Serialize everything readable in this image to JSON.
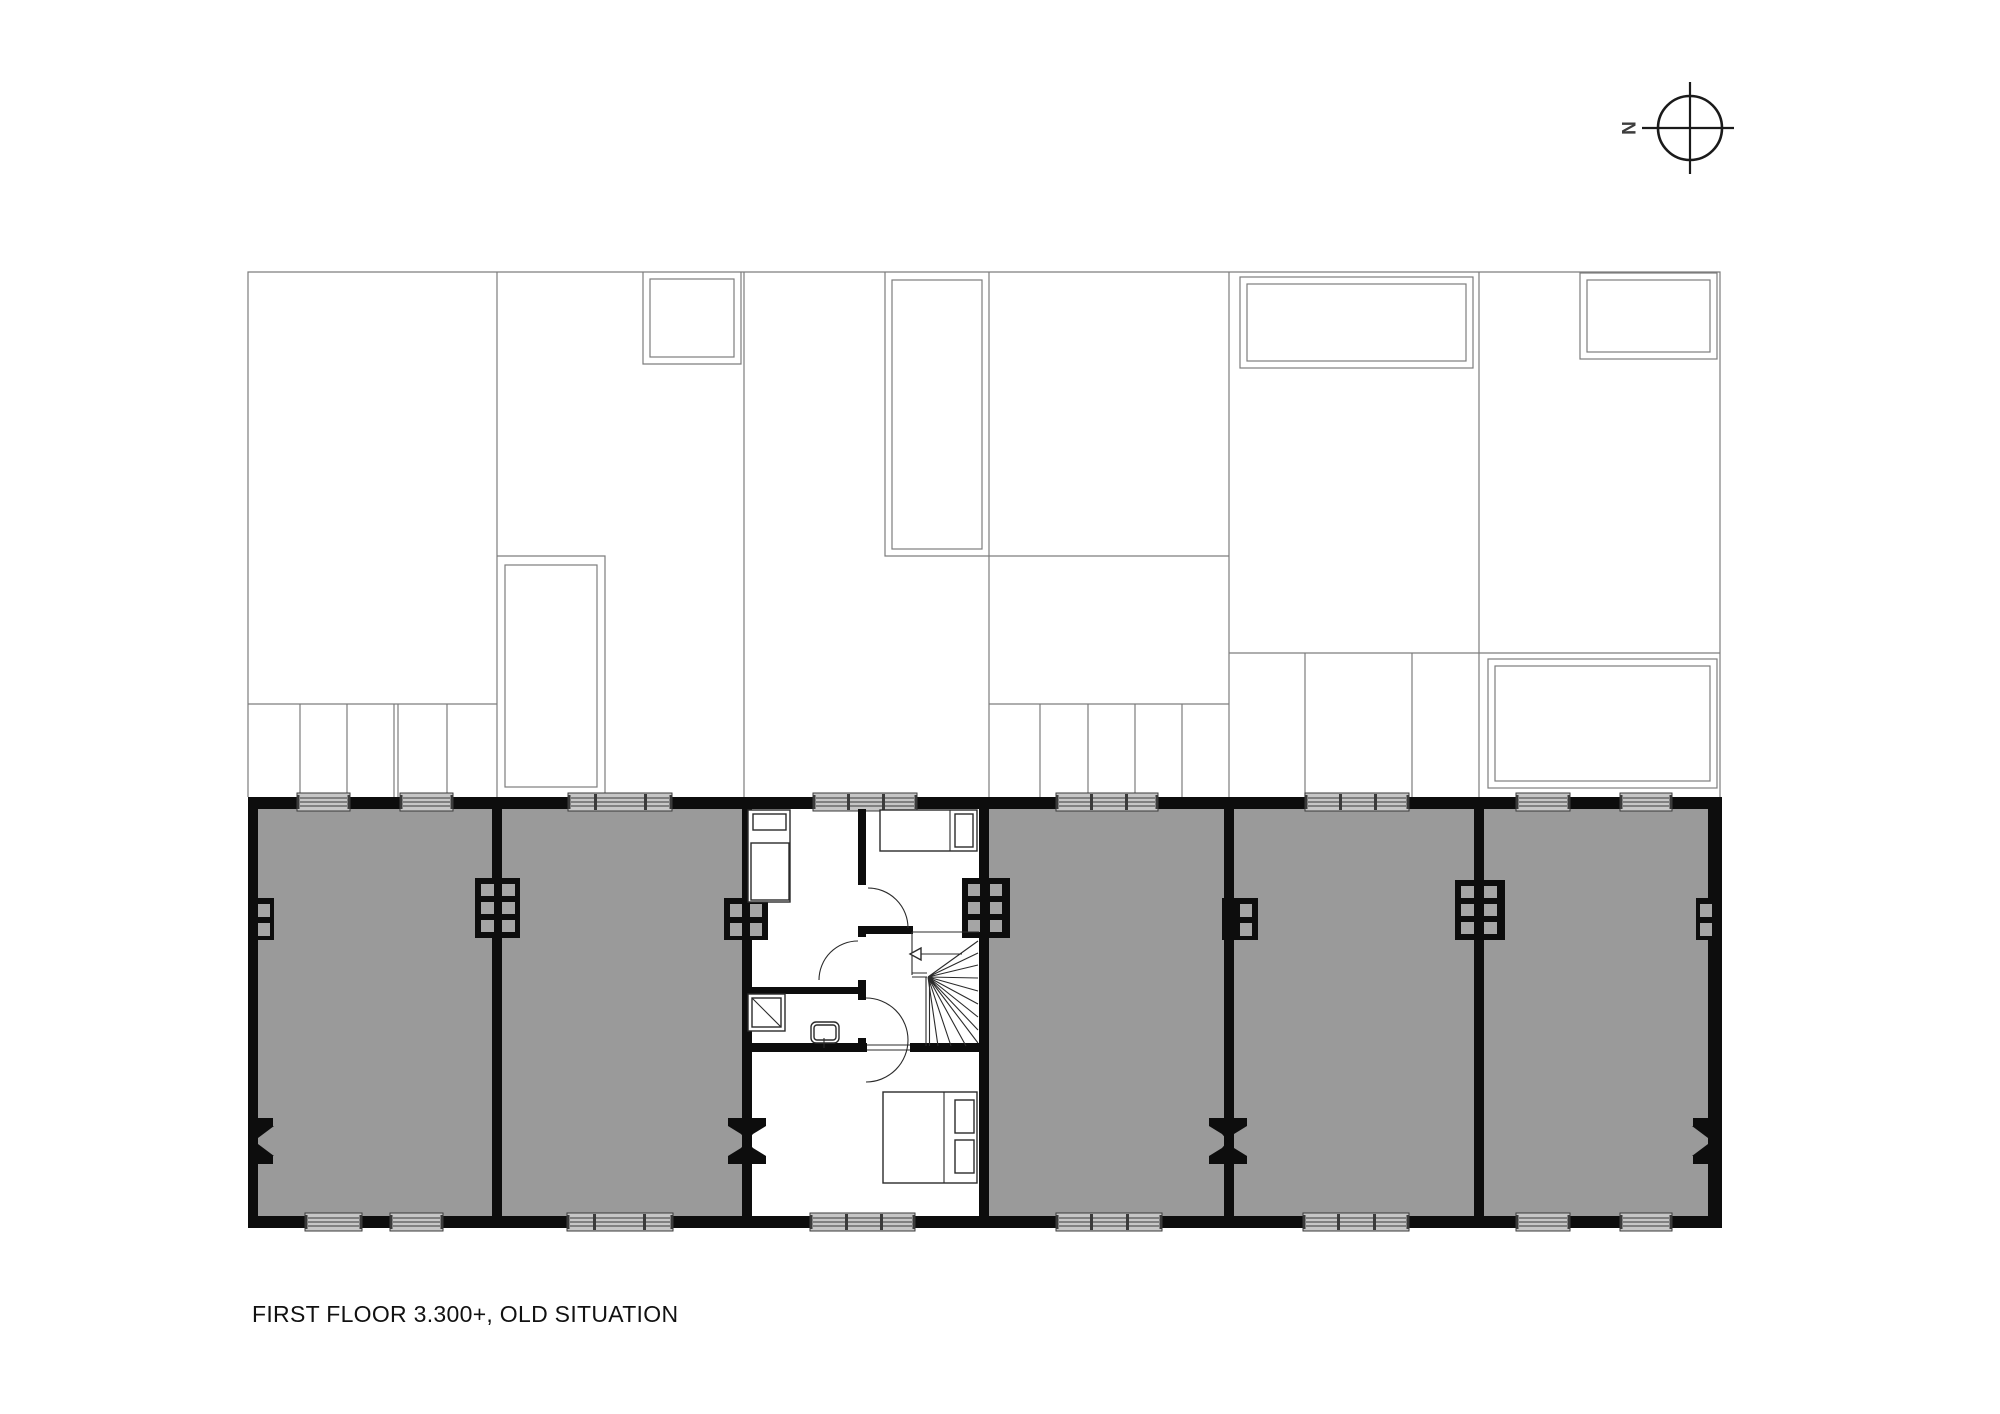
{
  "caption": {
    "text": "FIRST FLOOR 3.300+, OLD SITUATION"
  },
  "compass": {
    "label": "N",
    "points_to": "left"
  },
  "colors": {
    "background": "#ffffff",
    "wall": "#0d0d0d",
    "shaded-room": "#9a9a9a",
    "window-fill": "#c6c6c6",
    "window-stroke": "#3a3a3a",
    "upper-line": "#7d7d7d",
    "detail-stroke": "#2b2b2b",
    "chimney-square": "#a5a5a5",
    "text": "#111111"
  },
  "floor_plan": {
    "level_label": "first floor +3.300, old situation",
    "units": [
      {
        "name": "dwelling-1",
        "shaded": true
      },
      {
        "name": "dwelling-2",
        "shaded": true
      },
      {
        "name": "dwelling-3-centre",
        "shaded": false,
        "rooms": [
          "bedroom-left",
          "bedroom-right",
          "bathroom",
          "hall-with-winder-stair",
          "bedroom-bottom"
        ]
      },
      {
        "name": "dwelling-4",
        "shaded": true
      },
      {
        "name": "dwelling-5",
        "shaded": true
      },
      {
        "name": "dwelling-6",
        "shaded": true
      }
    ],
    "furniture": [
      "single-bed",
      "single-bed",
      "double-bed",
      "shower",
      "wash-basin",
      "winder-stair"
    ],
    "window_count": 16,
    "door_swing_count": 3
  }
}
